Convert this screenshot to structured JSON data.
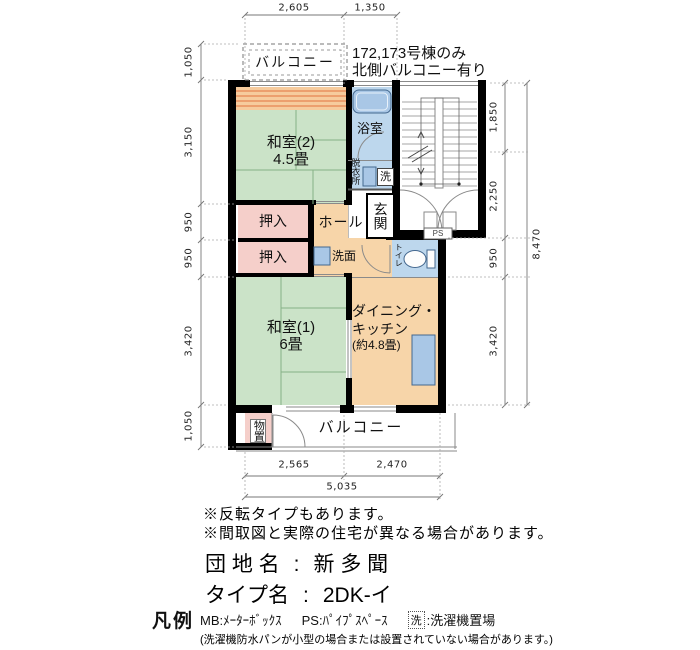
{
  "building_note": {
    "line1": "172,173号棟のみ",
    "line2": "北側バルコニー有り"
  },
  "rooms": {
    "balcony_top": "バルコニー",
    "washitsu2_name": "和室(2)",
    "washitsu2_size": "4.5畳",
    "bath": "浴室",
    "datsuijo": "脱衣所",
    "washer_mark": "洗",
    "genkan": "玄関",
    "hall": "ホール",
    "oshiire_upper": "押入",
    "oshiire_lower": "押入",
    "senmen": "洗面",
    "toilet": "トイレ",
    "washitsu1_name": "和室(1)",
    "washitsu1_size": "6畳",
    "dk_line1": "ダイニング・",
    "dk_line2": "キッチン",
    "dk_size": "(約4.8畳)",
    "monooki": "物置",
    "balcony_bottom": "バルコニー",
    "ps": "PS"
  },
  "dims": {
    "top": [
      "2,605",
      "1,350"
    ],
    "left": [
      "1,050",
      "3,150",
      "950",
      "950",
      "3,420",
      "1,050"
    ],
    "right": [
      "1,850",
      "2,250",
      "950",
      "3,420"
    ],
    "right_total": "8,470",
    "bottom": [
      "2,565",
      "2,470"
    ],
    "bottom_total": "5,035"
  },
  "notes": [
    "※反転タイプもあります。",
    "※間取図と実際の住宅が異なる場合があります。"
  ],
  "estate": {
    "name_label": "団 地 名",
    "name_sep": ":",
    "name_value": "新 多 聞",
    "type_label": "タイプ名",
    "type_sep": ":",
    "type_value": "2DK-イ"
  },
  "legend": {
    "title": "凡例",
    "mb": "MB:ﾒｰﾀｰﾎﾞｯｸｽ",
    "ps": "PS:ﾊﾟｲﾌﾟｽﾍﾟｰｽ",
    "washer_mark": "洗",
    "washer_label": ":洗濯機置場",
    "note": "(洗濯機防水パンが小型の場合または設置されていない場合があります。)"
  },
  "colors": {
    "tatami": "#cbe3c8",
    "service": "#f7d5a9",
    "closet": "#f5cfca",
    "wet": "#bdd7ed",
    "fixture": "#a9c7e6",
    "stripe": "#ec9f6e",
    "wall": "#000000"
  }
}
